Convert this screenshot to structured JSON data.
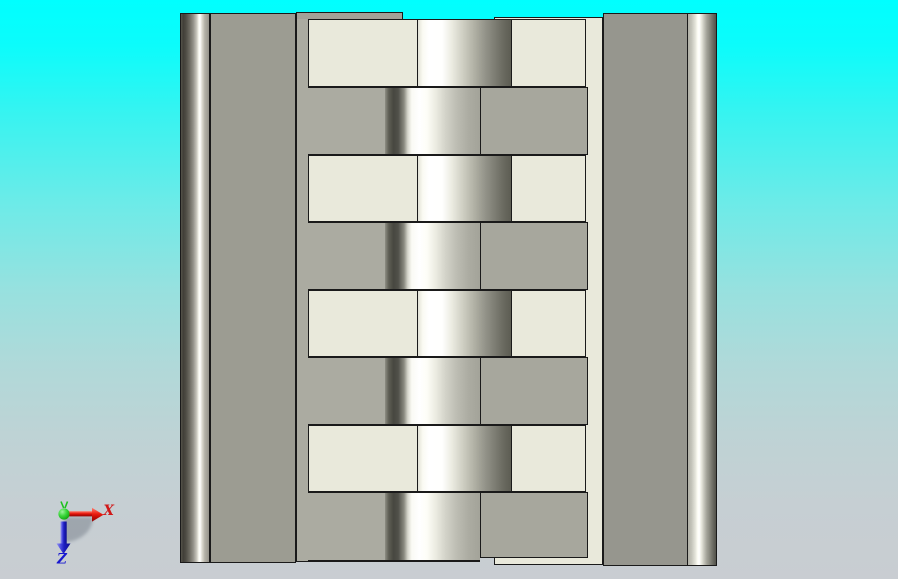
{
  "viewport": {
    "type": "cad-3d-viewport",
    "content": "hinge model, front view, leaves open flat",
    "background_top_color": "#00ffff",
    "background_bottom_color": "#c9cdd2"
  },
  "triad": {
    "origin_color": "#2ed32e",
    "shadow_color": "#767e89",
    "axes": [
      {
        "id": "x",
        "label": "X",
        "color": "#d01818",
        "direction": "right"
      },
      {
        "id": "y",
        "label": "",
        "color": "#1ec21e",
        "direction": "up-toward-viewer"
      },
      {
        "id": "z",
        "label": "Z",
        "color": "#1818d0",
        "direction": "down"
      }
    ]
  },
  "hinge": {
    "outline_color": "#1a1a1a",
    "materials": {
      "left_leaf_gray": "#9c9c92",
      "inner_gray": "#ababa1",
      "knuckle_gray": "#a7a79d",
      "right_leaf_gray": "#96968e",
      "cream": "#e9e9db"
    },
    "knuckle_rows": [
      "cream",
      "gray",
      "cream",
      "gray",
      "cream",
      "gray",
      "cream",
      "gray"
    ]
  }
}
